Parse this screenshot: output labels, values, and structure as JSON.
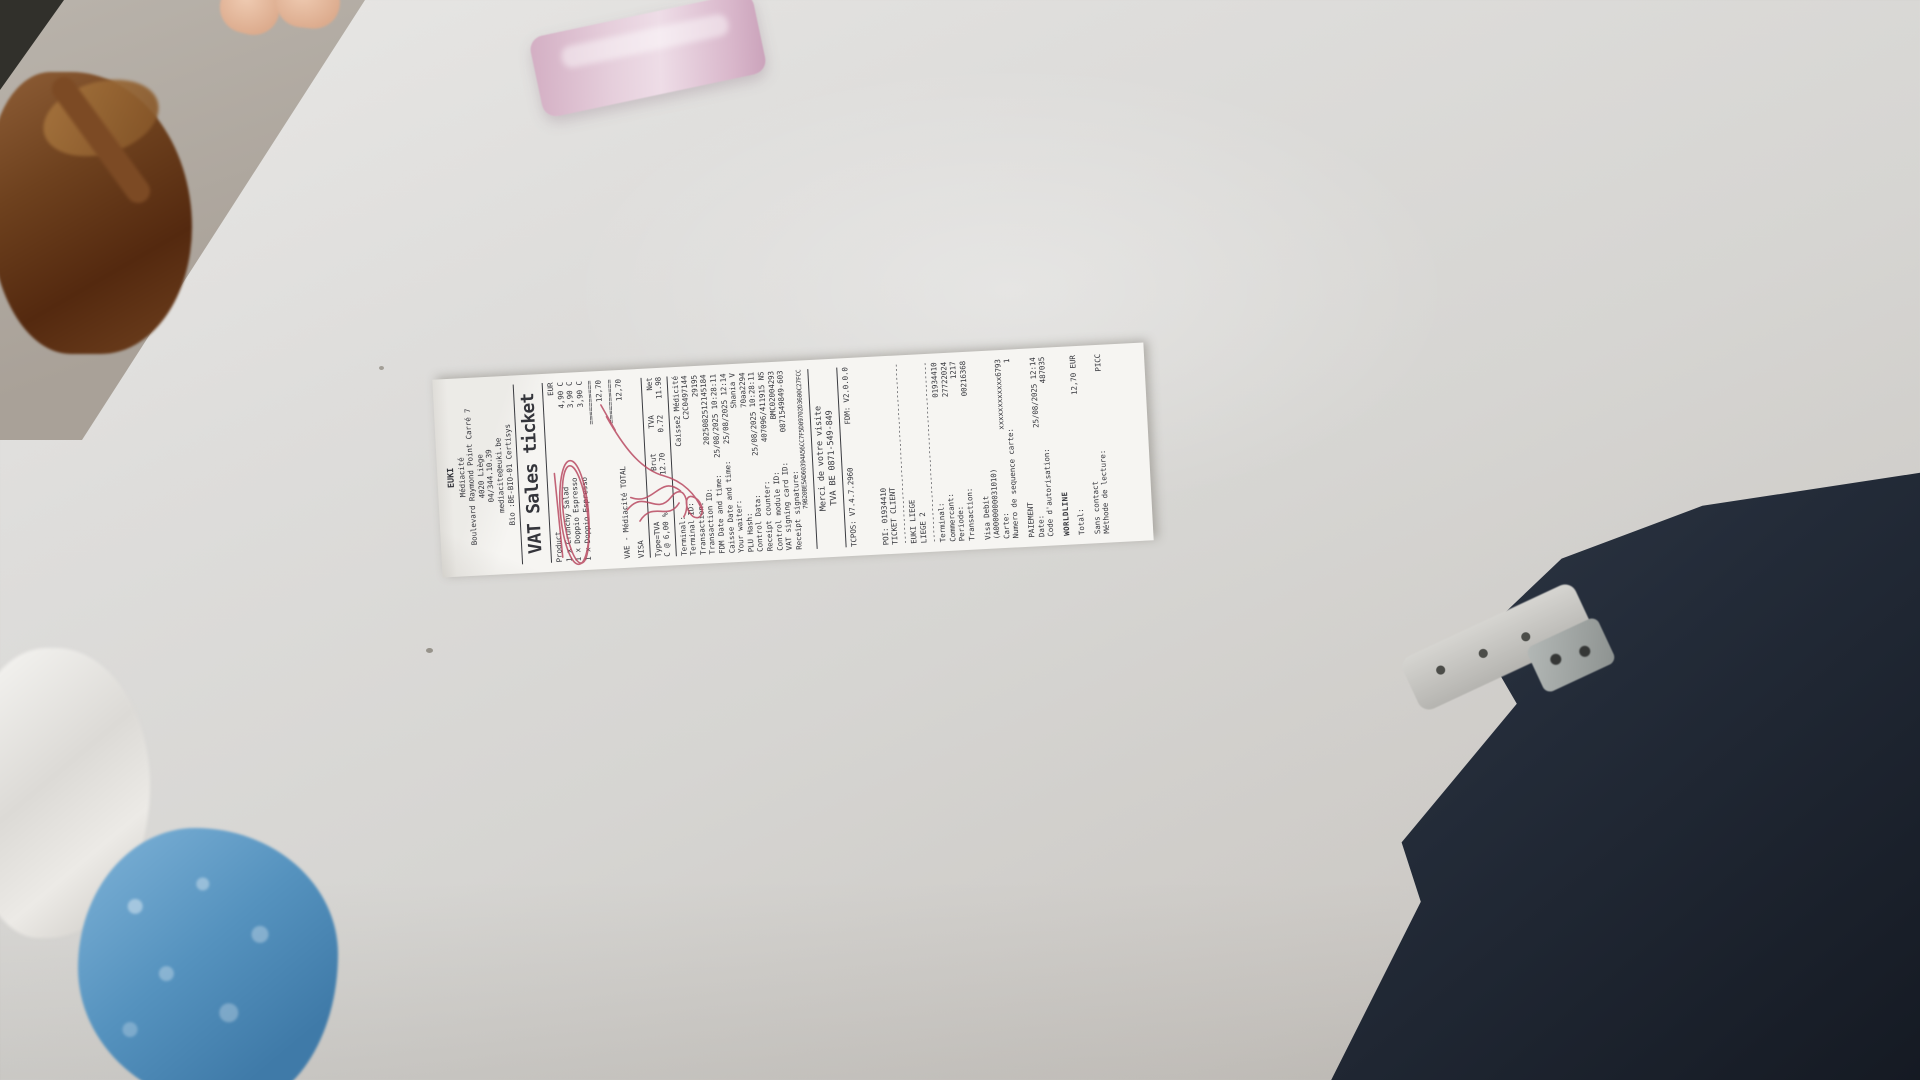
{
  "scene": {
    "description": "Photograph of a printed VAT sales receipt lying on a white table",
    "objects": [
      "person-hand",
      "leather-bag",
      "pink-object",
      "plastic-bag",
      "blue-object",
      "person-legs",
      "chair-frame",
      "receipt"
    ],
    "table_color": "#d6d5d2",
    "annotation_ink_color": "#b94a62"
  },
  "receipt": {
    "header": {
      "store": "EUKI",
      "location": "Médiacité",
      "address": "Boulevard Raymond Point Carré 7",
      "city": "4020 Liège",
      "phone": "04/344.10.39",
      "email": "mediacite@euki.be",
      "bio": "Bio :BE-BIO-01 Certisys"
    },
    "title": "VAT Sales ticket",
    "products": {
      "col_product": "Product",
      "col_currency": "EUR",
      "items": [
        {
          "line": "1  x Crunchy Salad",
          "price": "4,90 C"
        },
        {
          "line": "1  x Doppio Espresso",
          "price": "3,90 C"
        },
        {
          "line": "1  x Doppio Espresso",
          "price": "3,90 C"
        }
      ],
      "subtotal_rule": "==========",
      "subtotal": "12,70"
    },
    "total": {
      "label": "VAE - Médiacité TOTAL",
      "rule": "==========",
      "amount": "12,70"
    },
    "payment_method": "VISA",
    "vat_table": {
      "h_type": "Type=TVA",
      "h_brut": "Brut",
      "h_tva": "TVA",
      "h_net": "Net",
      "r_type": "C  @ 6,00 %",
      "r_brut": "12.70",
      "r_tva": "0.72",
      "r_net": "11.98"
    },
    "details": [
      {
        "label": "Terminal:",
        "value": "Caisse2 Médicité"
      },
      {
        "label": "Terminal ID:",
        "value": "C2C0497144"
      },
      {
        "label": "Transaction:",
        "value": "29195"
      },
      {
        "label": "Transaction ID:",
        "value": "2025082512145184"
      },
      {
        "label": "FDM Date and time:",
        "value": "25/08/2025 10:28:11"
      },
      {
        "label": "Caisse Date and time:",
        "value": "25/08/2025 12:14"
      },
      {
        "label": "Your waiter:",
        "value": "Shania V"
      },
      {
        "label": "PLU Hash:",
        "value": "70aa2294"
      },
      {
        "label": "Control Data:",
        "value": "25/08/2025 10:28:11"
      },
      {
        "label": "Receipt counter:",
        "value": "407096/411915 NS"
      },
      {
        "label": "Control module ID:",
        "value": "BMC02004293"
      },
      {
        "label": "VAT signing card ID:",
        "value": "0871549849-603"
      },
      {
        "label": "Receipt signature:",
        "value": ""
      }
    ],
    "signature_hash": "79B20BE5AD60394A56CC7F5D09702D3600C27FCC",
    "footer": {
      "thanks": "Merci de votre visite",
      "vat_number": "TVA BE 0871-549-849",
      "tcpos": "TCPOS: V7.4.7.2960",
      "fdm": "FDM: V2.0.0.0"
    },
    "card": {
      "poi": "POI: 01934410",
      "ticket_client": "TICKET CLIENT",
      "divider": "---------------------------------------------",
      "store_line1": "EUKI LIEGE",
      "store_line2": "LIEGE 2",
      "terminal_rows": [
        {
          "label": "Terminal:",
          "value": "01934410"
        },
        {
          "label": "Commercant:",
          "value": "27722024"
        },
        {
          "label": "Periode:",
          "value": "1217"
        },
        {
          "label": "Transaction:",
          "value": "00216368"
        }
      ],
      "card_type": "Visa Debit",
      "aid": "(A0000000031010)",
      "carte_label": "Carte:",
      "carte_value": "xxxxxxxxxxxx6793",
      "seq_label": "Numero de sequence carte:",
      "seq_value": "1",
      "paiement": "PAIEMENT",
      "date_label": "Date:",
      "date_value": "25/08/2025 12:14",
      "auth_label": "Code d'autorisation:",
      "auth_value": "487035",
      "brand": "WORLDLINE",
      "total_label": "Total:",
      "total_value": "12,70 EUR",
      "contactless": "Sans contact",
      "read_method_label": "Méthode de lecture:",
      "read_method_value": "PICC"
    }
  }
}
